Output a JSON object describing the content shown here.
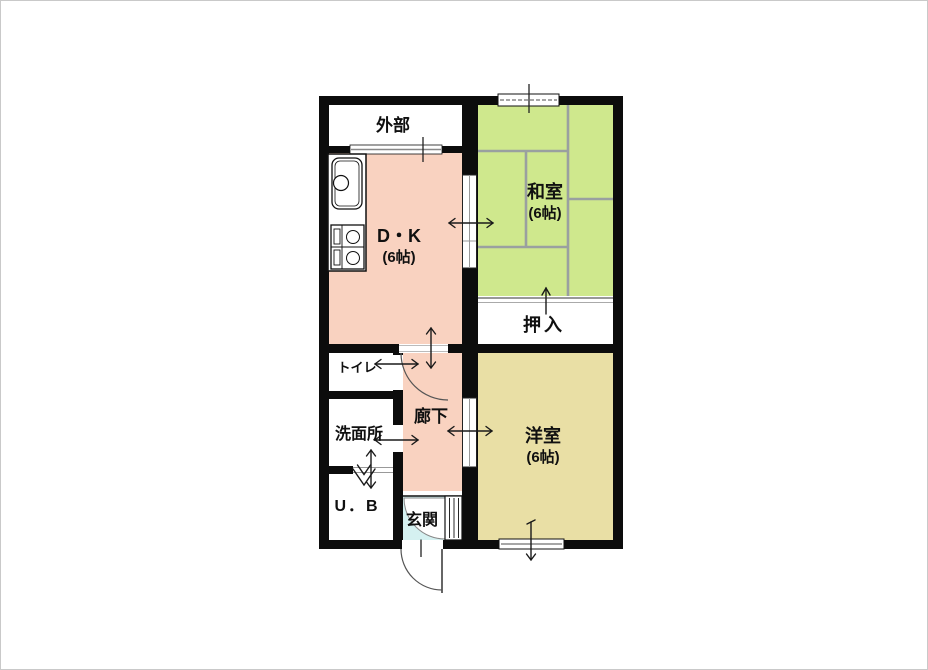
{
  "plan": {
    "rooms": {
      "gaibu": {
        "label": "外部"
      },
      "dk": {
        "label": "D・K",
        "size": "(6帖)"
      },
      "washitsu": {
        "label": "和室",
        "size": "(6帖)"
      },
      "oshiire": {
        "label": "押入"
      },
      "toilet": {
        "label": "トイレ"
      },
      "senmenjo": {
        "label": "洗面所"
      },
      "unit_bath": {
        "label": "U．B"
      },
      "rouka": {
        "label": "廊下"
      },
      "genkan": {
        "label": "玄関"
      },
      "yoshitsu": {
        "label": "洋室",
        "size": "(6帖)"
      }
    },
    "colors": {
      "wall": "#0c0c0c",
      "dk_fill": "#f9d2c0",
      "washitsu_fill": "#cfe88d",
      "yoshitsu_fill": "#e9dfa5",
      "genkan_fill": "#d5f1f1",
      "room_white": "#ffffff",
      "tatami_line": "#9aa0a0"
    }
  }
}
